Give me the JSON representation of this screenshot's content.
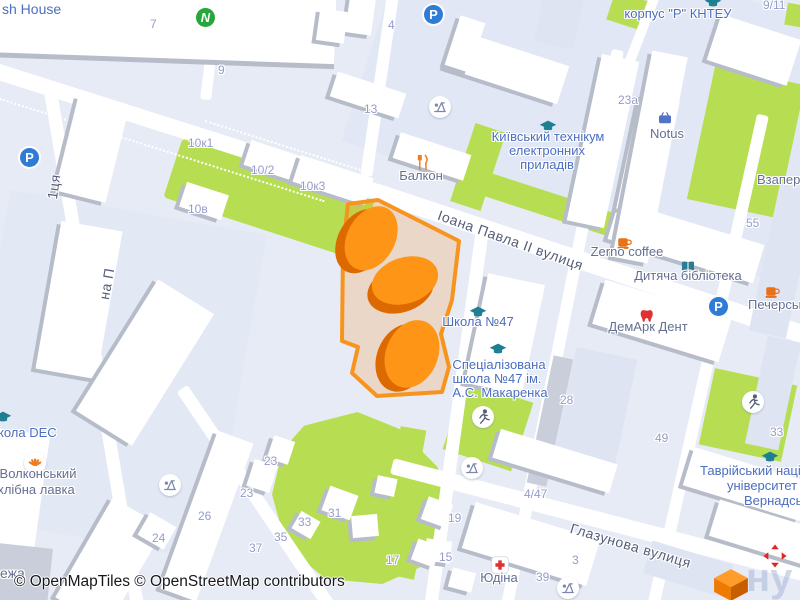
{
  "map": {
    "attribution": "© OpenMapTiles © OpenStreetMap contributors",
    "streets": {
      "main": "Іоана Павла II вулиця",
      "south": "Глазунова вулиця",
      "left_fragment_top": "1ця",
      "left_fragment_bottom": "на П"
    },
    "pois": [
      {
        "icon": "restaurant-icon",
        "label": "Балкон"
      },
      {
        "icon": "graduation-cap-icon",
        "lines": [
          "Київський технікум",
          "електронних",
          "приладів"
        ]
      },
      {
        "icon": "graduation-cap-icon",
        "label": "корпус \"Р\" КНТЕУ"
      },
      {
        "icon": "basket-icon",
        "label": "Notus"
      },
      {
        "icon": "coffee-icon",
        "label": "Zerno coffee"
      },
      {
        "icon": "book-icon",
        "label": "Дитяча бібліотека"
      },
      {
        "icon": "tooth-icon",
        "label": "ДемАрк Дент"
      },
      {
        "icon": "coffee-icon",
        "label": "Печерськ"
      },
      {
        "icon": "graduation-cap-icon",
        "label": "Школа №47"
      },
      {
        "icon": "graduation-cap-icon",
        "lines": [
          "Спеціалізована",
          "школа №47 ім.",
          "А.С. Макаренка"
        ]
      },
      {
        "icon": "graduation-cap-icon",
        "lines": [
          "Таврійський націон",
          "університет ім",
          "Вернадсько"
        ]
      },
      {
        "icon": "graduation-cap-icon",
        "label": "кола DEC"
      },
      {
        "icon": "bakery-icon",
        "lines": [
          "Волконський",
          "хлібна лавка"
        ]
      },
      {
        "icon": "hospital-icon",
        "label": "Юдіна"
      },
      {
        "label": "sh House"
      },
      {
        "label": "Взаперт"
      },
      {
        "label": "ежа"
      }
    ],
    "house_numbers": [
      "7",
      "9",
      "9/11",
      "4",
      "13",
      "10к1",
      "10/2",
      "10к3",
      "10в",
      "23a",
      "55",
      "28",
      "4/47",
      "19",
      "15",
      "3",
      "39",
      "23",
      "23",
      "26",
      "24",
      "31",
      "33",
      "35",
      "37",
      "17",
      "33",
      "49"
    ],
    "icons": {
      "parking_letter": "P",
      "novus_letter": "N"
    },
    "watermark": "ну",
    "colors": {
      "highlight_border": "#F7941E",
      "highlight_fill": "rgba(247,147,30,0.22)",
      "orange_building": "#FF9517",
      "orange_building_shade": "#DD6A00",
      "green_area": "#B7DE52",
      "parking_blue": "#2E7CD6",
      "novus_green": "#25A73C",
      "education_teal": "#1F7F92",
      "poi_label_blue": "#4C6EBF",
      "shop_label_gray": "#646F92",
      "number_lavender": "#959CC9",
      "red": "#E03131",
      "background": "#E7EBF6"
    }
  }
}
